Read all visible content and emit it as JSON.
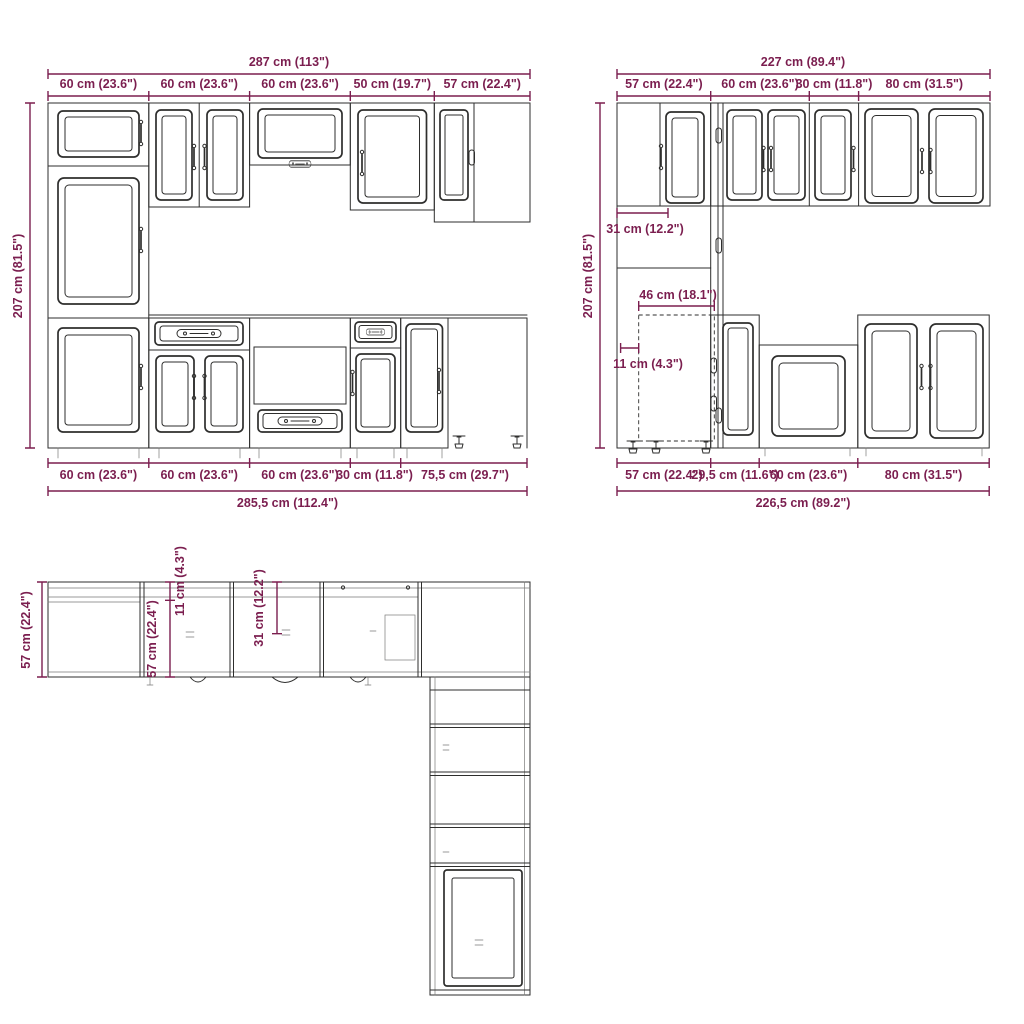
{
  "colors": {
    "dimension": "#7b1e4f",
    "line_art": "#2e2e2d",
    "background": "#ffffff"
  },
  "front_elevation": {
    "total_top": "287 cm (113\")",
    "segments_top": [
      "60 cm (23.6\")",
      "60 cm (23.6\")",
      "60 cm (23.6\")",
      "50 cm (19.7\")",
      "57 cm (22.4\")"
    ],
    "height": "207 cm (81.5\")",
    "segments_bottom": [
      "60 cm (23.6\")",
      "60 cm (23.6\")",
      "60 cm (23.6\")",
      "30 cm (11.8\")",
      "75,5 cm (29.7\")"
    ],
    "total_bottom": "285,5 cm (112.4\")"
  },
  "side_elevation": {
    "total_top": "227 cm (89.4\")",
    "segments_top": [
      "57 cm (22.4\")",
      "60 cm (23.6\")",
      "30 cm (11.8\")",
      "80 cm (31.5\")"
    ],
    "height": "207 cm (81.5\")",
    "wall_depth": "31 cm (12.2\")",
    "base_depth": "46 cm (18.1\")",
    "plinth_offset": "11 cm (4.3\")",
    "segments_bottom": [
      "57 cm (22.4\")",
      "29,5 cm (11.6\")",
      "60 cm (23.6\")",
      "80 cm (31.5\")"
    ],
    "total_bottom": "226,5 cm (89.2\")"
  },
  "plan_view": {
    "outer_depth": "57 cm (22.4\")",
    "inner_depth": "57 cm (22.4\")",
    "plinth_offset": "11 cm (4.3\")",
    "wall_depth": "31 cm (12.2\")"
  }
}
